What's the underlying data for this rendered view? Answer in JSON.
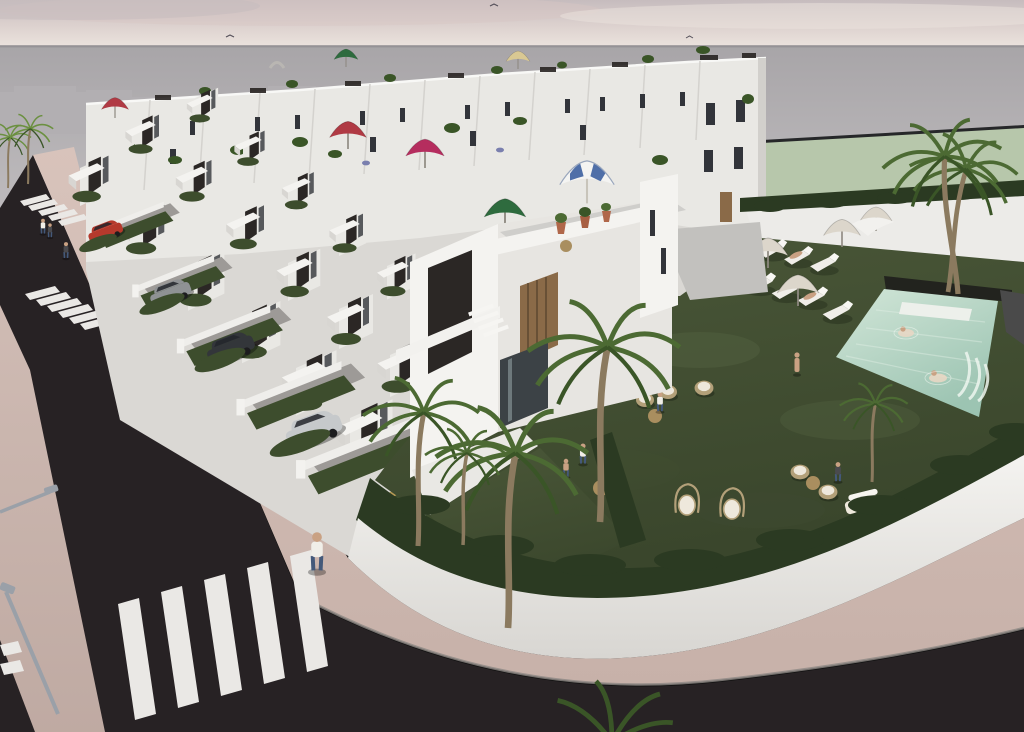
{
  "meta": {
    "title": "Aerial 3D render of a new-build white townhouse development with communal pool garden, street with crosswalks and parked cars",
    "scene_type": "architectural-visualization",
    "lighting": "overcast pink-grey dusk sky"
  },
  "palette": {
    "sky_top": "#c6bcbe",
    "sky_mid": "#ddd2cf",
    "sky_horizon": "#ece4de",
    "cloud_pink": "#d8c6c4",
    "sea_top": "#a8a5a8",
    "sea_bottom": "#c6c3c5",
    "horizon_line": "#8f8c90",
    "distant_block": "#b2afb2",
    "field_green": "#b7c7ab",
    "fence_dark": "#1a1b1d",
    "underlay": "#dad8d4",
    "white_lit": "#f4f3f0",
    "white_std": "#e9e8e4",
    "white_shade": "#d8d6d2",
    "gray_floor": "#cfcecb",
    "panel_dark": "#2b2725",
    "window_dark": "#32343a",
    "glass_dark": "#3c4246",
    "wood_slat": "#8a6a48",
    "lawn_top": "#4a5738",
    "lawn_bottom": "#3a462c",
    "lawn_light": "#55634203",
    "hedge_dark": "#2b3a22",
    "hedge_front": "#3d4d2d",
    "road": "#272224",
    "stripe_white": "#eae8e5",
    "paving_top": "#d8c3bb",
    "paving_bottom": "#c7b1a9",
    "curb": "#8d8884",
    "drive_gray": "#9d9a97",
    "ramp_gray": "#c2c1be",
    "pool_light": "#d2e6d8",
    "pool_deep": "#9cc4b2",
    "pool_bench": "#edf0eb",
    "planter_dark": "#22231e",
    "palm_trunk": "#8b7a5f",
    "palm_green": "#4c6a33",
    "palm_green_dark": "#3a5527",
    "palm_bright": "#6b9040",
    "umbrella_red": "#b03a44",
    "umbrella_green": "#2e6b3e",
    "umbrella_magenta": "#b52d5e",
    "umbrella_beige": "#d9c893",
    "umbrella_blue": "#4f6fa8",
    "umbrella_pale": "#dcd6cb",
    "car_red": "#b5392c",
    "car_gray": "#8f9294",
    "car_dark": "#33363a",
    "car_silver": "#c6c9cb",
    "car_gold": "#b79a55",
    "skin": "#c9a183",
    "jeans": "#44597a",
    "shirt_white": "#f0eee8",
    "shirt_dark": "#4a4a4e",
    "lamp_gray": "#9aa0a8",
    "wicker": "#b3a079",
    "cushion": "#eee8dc",
    "table_wood": "#a98e5f"
  },
  "scene": {
    "sky": {
      "birds": 3
    },
    "background": {
      "sea_visible": true,
      "distant_buildings": 5,
      "green_field_strip": true
    },
    "development": {
      "back_row_units": 11,
      "back_row_windows": 18,
      "roofline_umbrellas": [
        {
          "name": "green-roof-umbrella",
          "color_key": "umbrella_green"
        },
        {
          "name": "beige-roof-umbrella",
          "color_key": "umbrella_beige"
        }
      ],
      "terrace_umbrellas": [
        {
          "name": "red-umbrella-far-left",
          "color_key": "umbrella_red"
        },
        {
          "name": "red-umbrella-center",
          "color_key": "umbrella_red"
        },
        {
          "name": "magenta-umbrella",
          "color_key": "umbrella_magenta"
        },
        {
          "name": "green-umbrella",
          "color_key": "umbrella_green"
        }
      ],
      "hero_house": {
        "roof_umbrella": "blue-white-striped",
        "roof_pots": 3,
        "accent_panels": "dark charcoal",
        "wood_louvre_door": true
      },
      "middle_rows": 3,
      "front_plots": 6
    },
    "street": {
      "crosswalks": 3,
      "street_lamps": 2,
      "pedestrians": 4,
      "cars": [
        {
          "name": "red-hatchback",
          "color_key": "car_red"
        },
        {
          "name": "gray-hatchback",
          "color_key": "car_gray"
        },
        {
          "name": "dark-suv",
          "color_key": "car_dark"
        },
        {
          "name": "silver-hatchback",
          "color_key": "car_silver"
        },
        {
          "name": "gold-hatchback",
          "color_key": "car_gold"
        }
      ]
    },
    "communal_garden": {
      "lawn": true,
      "palm_trees": 9,
      "pool": {
        "swimmers": 2,
        "waterfall_jets": 3,
        "white_bench": true
      },
      "sun_loungers": 11,
      "pale_umbrellas": 4,
      "furniture": {
        "wicker_chairs": 7,
        "hanging_egg_chairs": 2,
        "round_tables": 4,
        "garden_sofa": 1
      },
      "people": 7
    }
  }
}
